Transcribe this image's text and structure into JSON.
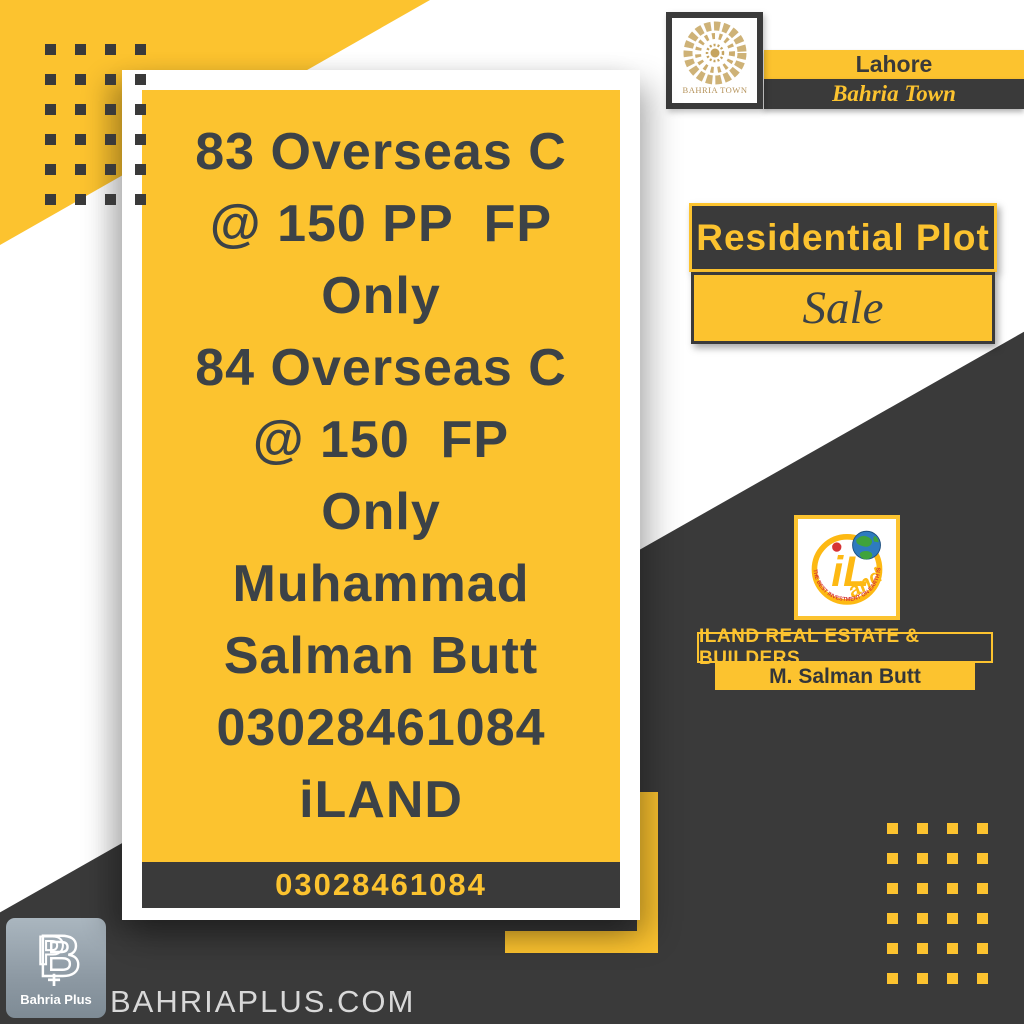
{
  "colors": {
    "yellow": "#FCC32F",
    "charcoal": "#3A3A3A",
    "card_text": "#3C4247",
    "gold": "#C6A45F",
    "red": "#D63434",
    "footer_text": "#D8D8D8"
  },
  "top_right": {
    "emblem_caption": "BAHRIA TOWN",
    "city": "Lahore",
    "brand_script": "Bahria Town"
  },
  "badges": {
    "listing_type": "Residential Plot",
    "status": "Sale"
  },
  "card": {
    "lines": [
      "83 Overseas C",
      "@ 150 PP  FP",
      "Only",
      "84 Overseas C",
      "@ 150  FP",
      "Only",
      "Muhammad",
      "Salman Butt",
      "03028461084",
      "iLAND"
    ],
    "phone": "03028461084"
  },
  "agency": {
    "logo_main": "iL",
    "logo_script": "and",
    "logo_tagline": "THE BEST INVESTMENT ON EARTH IS EARTH",
    "name": "ILAND REAL ESTATE & BUILDERS",
    "agent": "M. Salman Butt"
  },
  "footer": {
    "monogram_b": "B",
    "monogram_p": "P",
    "monogram_plus": "+",
    "logo_label": "Bahria Plus",
    "website": "BAHRIAPLUS.COM"
  }
}
